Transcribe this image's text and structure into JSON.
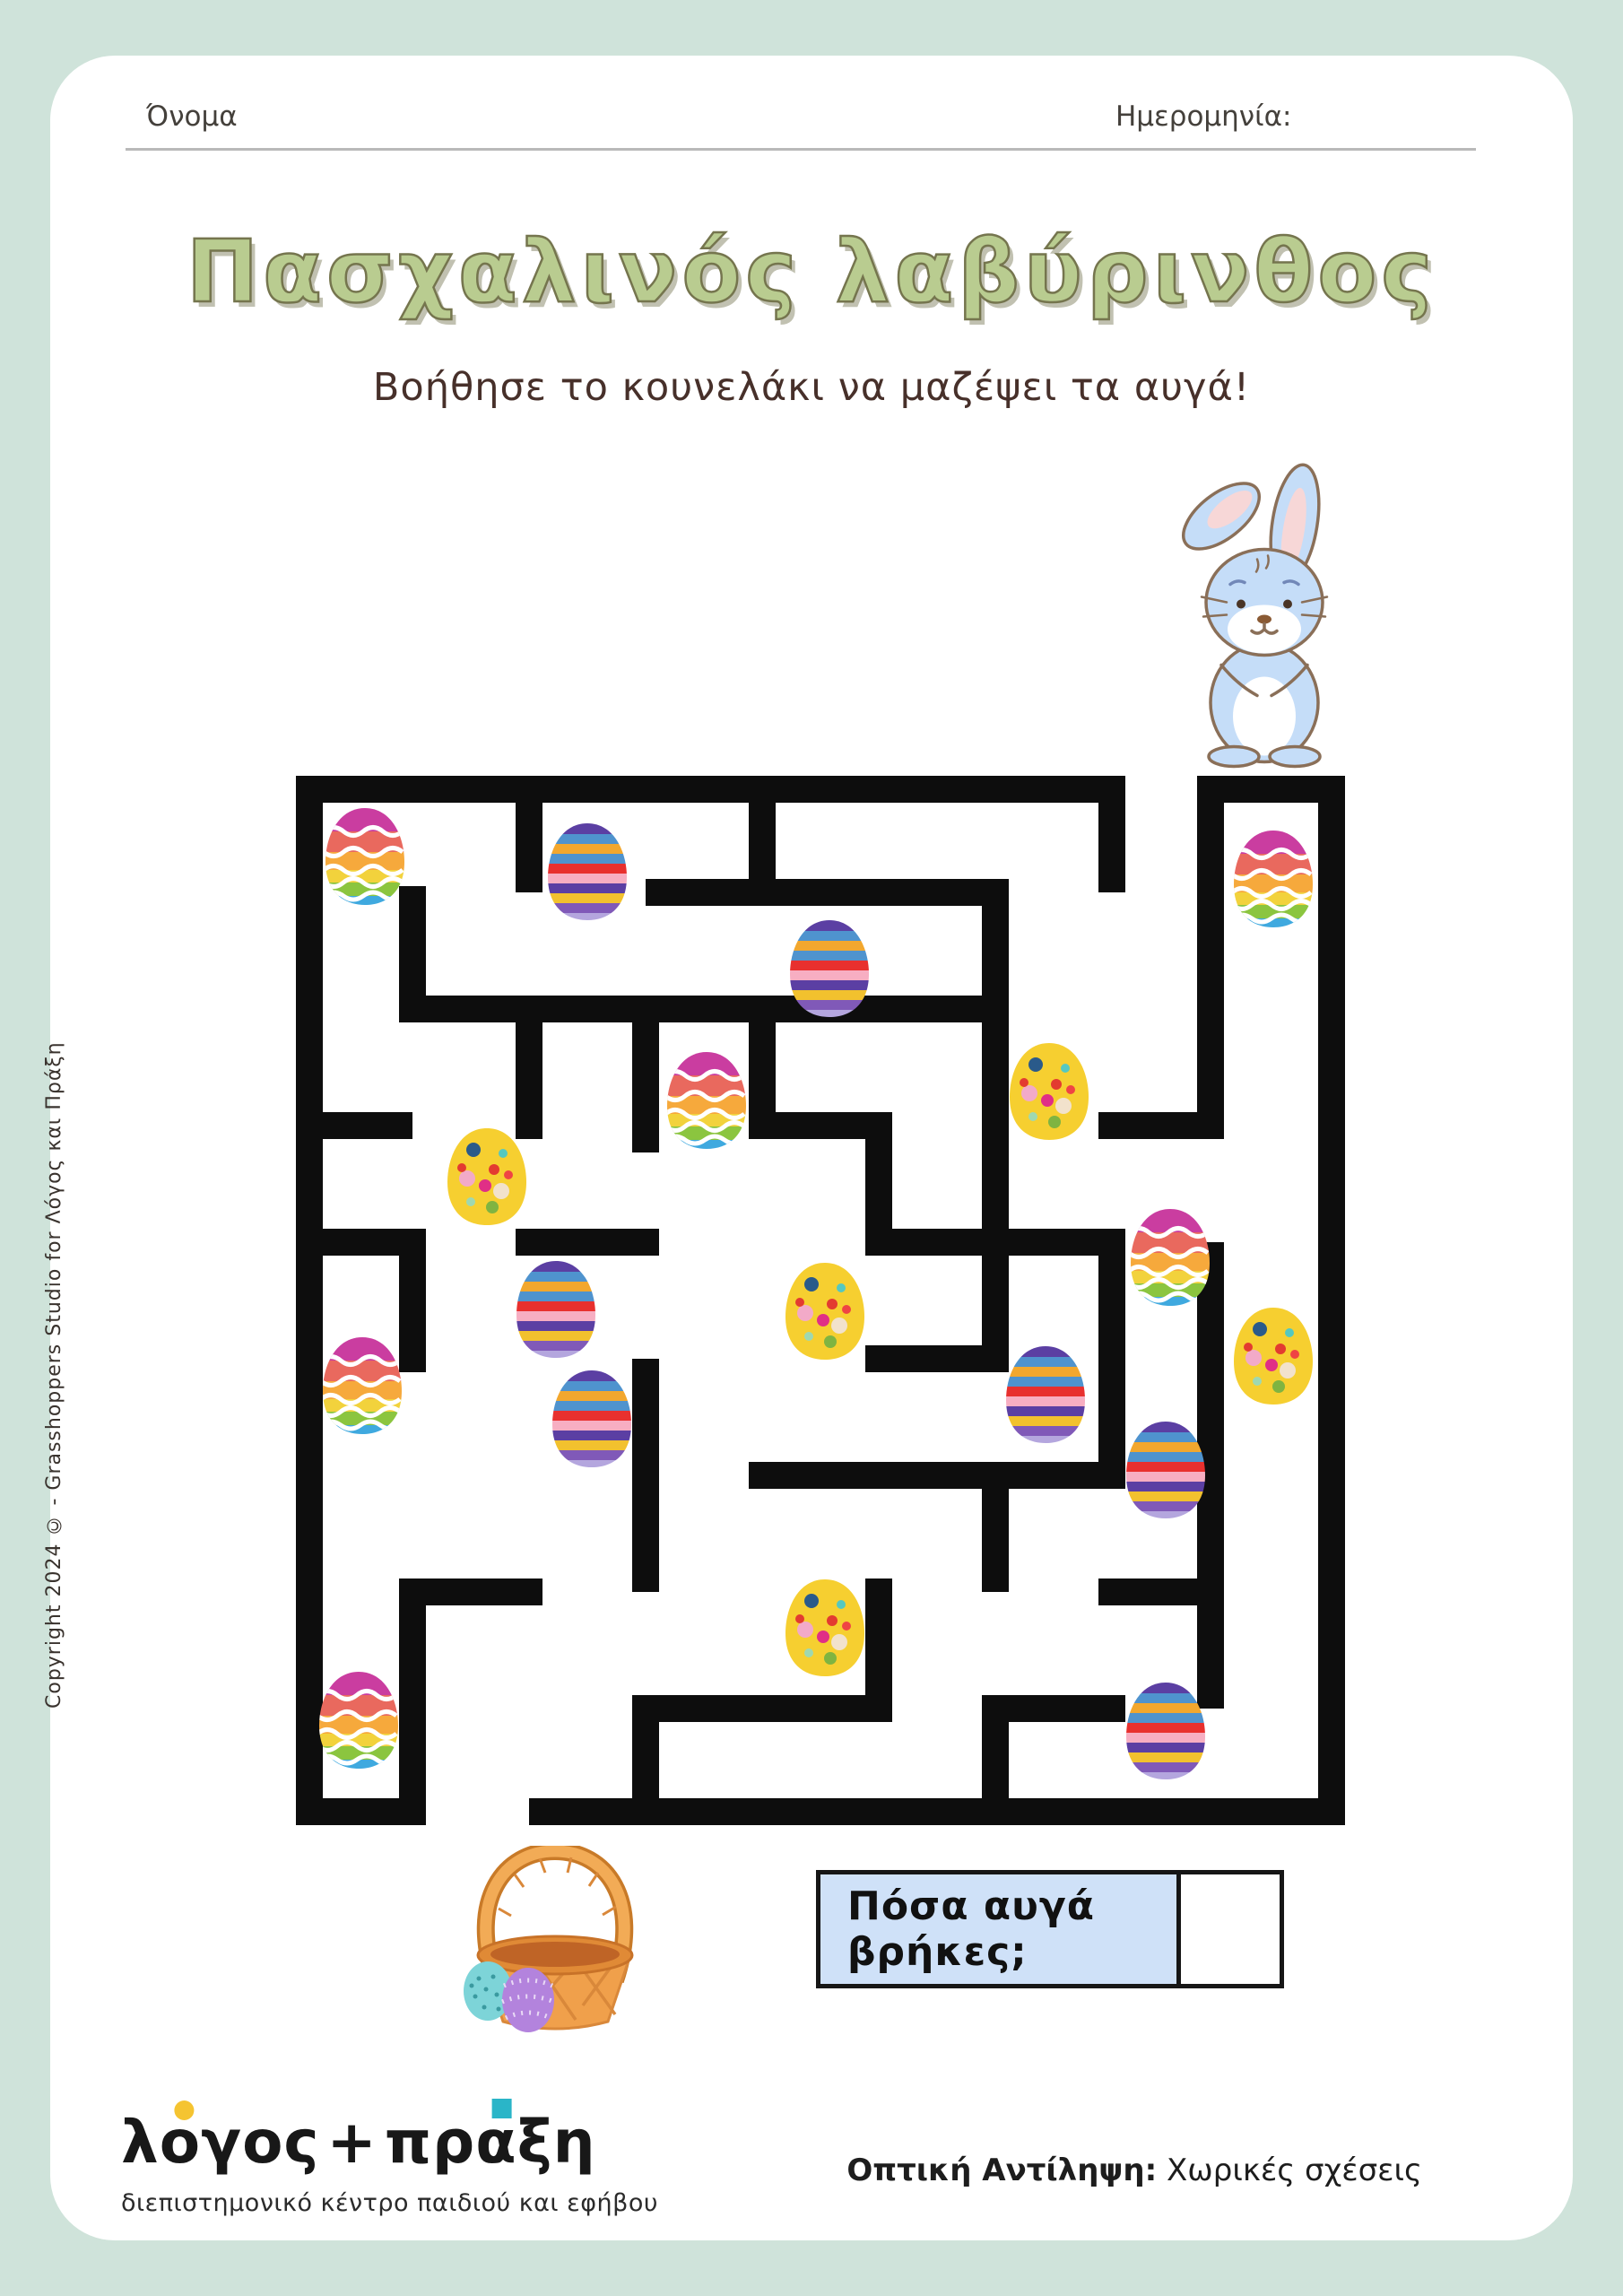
{
  "page": {
    "background_color": "#cfe3da",
    "card_color": "#ffffff"
  },
  "header": {
    "name_label": "Όνομα",
    "date_label": "Ημερομηνία:"
  },
  "title": {
    "text": "Πασχαλινός λαβύρινθος",
    "color": "#b9cc90"
  },
  "subtitle": "Βοήθησε το κουνελάκι να μαζέψει τα αυγά!",
  "question": {
    "label": "Πόσα αυγά βρήκες;",
    "answer": "",
    "box_color": "#cfe1f8"
  },
  "brand": {
    "name": "λόγος+πράξη",
    "parts": {
      "p1": "λ",
      "p2": "ο",
      "p3": "γος",
      "p4": "+",
      "p5": "πρ",
      "p6": "α",
      "p7": "ξη"
    },
    "tagline": "διεπιστημονικό κέντρο παιδιού και εφήβου",
    "dot_color": "#f5c431",
    "square_color": "#2ab5c8"
  },
  "category": {
    "label_bold": "Οπτική Αντίληψη:",
    "label_rest": " Χωρικές σχέσεις"
  },
  "copyright_vertical": "Copyright 2024 © - Grasshoppers Studio for Λόγος και Πράξη"
}
